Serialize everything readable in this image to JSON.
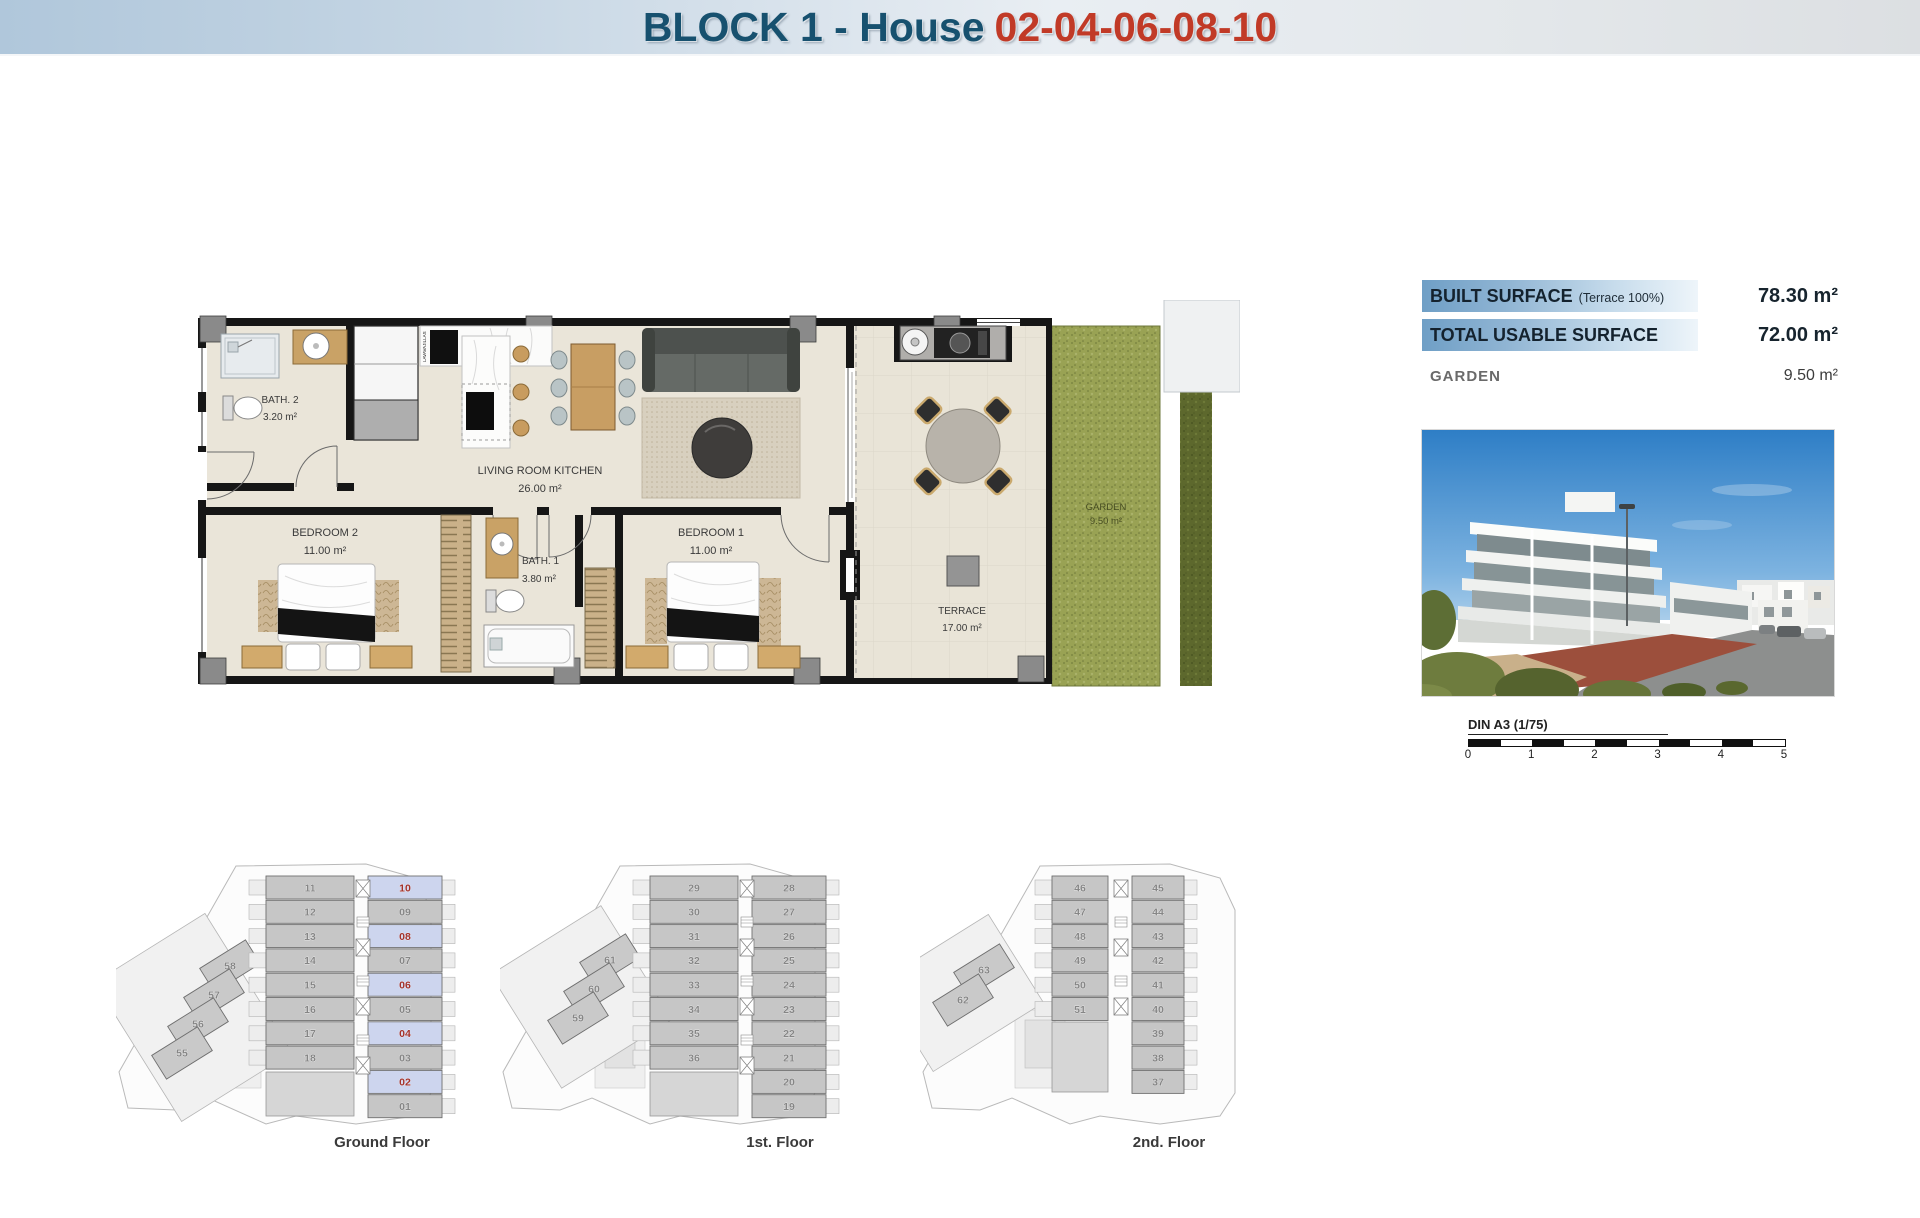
{
  "header": {
    "title_block": "BLOCK 1 - House",
    "title_numbers": "02-04-06-08-10"
  },
  "surface_table": {
    "rows": [
      {
        "label": "BUILT SURFACE",
        "note": "(Terrace 100%)",
        "value": "78.30 m²"
      },
      {
        "label": "TOTAL USABLE SURFACE",
        "note": "",
        "value": "72.00 m²"
      },
      {
        "label": "GARDEN",
        "note": "",
        "value": "9.50 m²"
      }
    ]
  },
  "scalebar": {
    "label": "DIN A3 (1/75)",
    "ticks": [
      "0",
      "1",
      "2",
      "3",
      "4",
      "5"
    ]
  },
  "floorplan": {
    "rooms": {
      "bath2": {
        "name": "BATH. 2",
        "area": "3.20 m²"
      },
      "living": {
        "name": "LIVING ROOM KITCHEN",
        "area": "26.00 m²"
      },
      "bedroom2": {
        "name": "BEDROOM 2",
        "area": "11.00 m²"
      },
      "bath1": {
        "name": "BATH. 1",
        "area": "3.80 m²"
      },
      "bedroom1": {
        "name": "BEDROOM 1",
        "area": "11.00 m²"
      },
      "terrace": {
        "name": "TERRACE",
        "area": "17.00 m²"
      },
      "garden": {
        "name": "GARDEN",
        "area": "9.50 m²"
      }
    },
    "appliance_label": "LAVAVAJILLAS"
  },
  "floors": [
    {
      "label": "Ground Floor",
      "diagonal": [
        "58",
        "57",
        "56",
        "55"
      ],
      "middle": [
        "11",
        "12",
        "13",
        "14",
        "15",
        "16",
        "17",
        "18"
      ],
      "right": [
        "10",
        "09",
        "08",
        "07",
        "06",
        "05",
        "04",
        "03",
        "02",
        "01"
      ],
      "highlighted": [
        "10",
        "08",
        "06",
        "04",
        "02"
      ]
    },
    {
      "label": "1st. Floor",
      "diagonal": [
        "61",
        "60",
        "59"
      ],
      "middle": [
        "29",
        "30",
        "31",
        "32",
        "33",
        "34",
        "35",
        "36"
      ],
      "right": [
        "28",
        "27",
        "26",
        "25",
        "24",
        "23",
        "22",
        "21",
        "20",
        "19"
      ],
      "highlighted": []
    },
    {
      "label": "2nd. Floor",
      "diagonal": [
        "63",
        "62"
      ],
      "middle": [
        "46",
        "47",
        "48",
        "49",
        "50",
        "51"
      ],
      "right": [
        "45",
        "44",
        "43",
        "42",
        "41",
        "40",
        "39",
        "38",
        "37"
      ],
      "highlighted": []
    }
  ],
  "colors": {
    "accent_red": "#c13a27",
    "accent_blue": "#17516f",
    "highlight_cell": "#cdd5ee",
    "highlight_text": "#a3322b",
    "cell_gray": "#c6c6c6",
    "cell_text": "#868686"
  }
}
